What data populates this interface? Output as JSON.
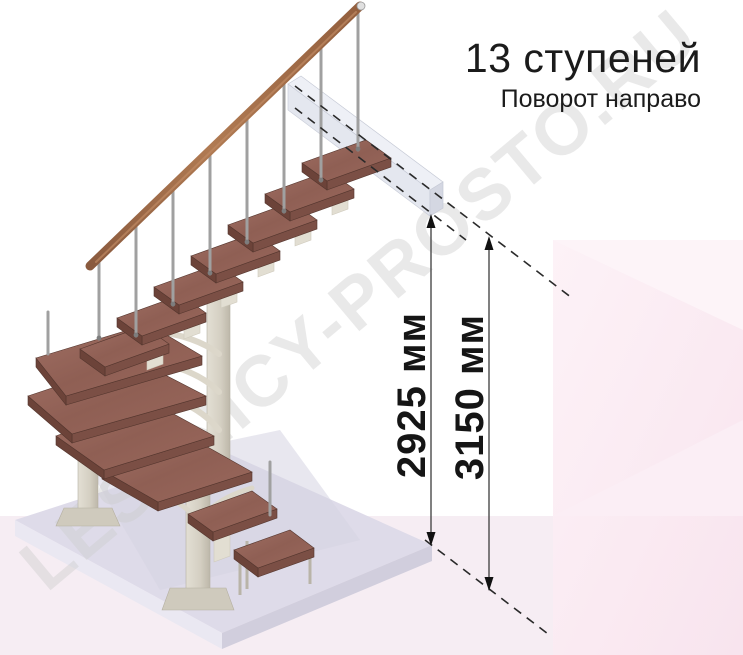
{
  "header": {
    "title": "13 ступеней",
    "subtitle": "Поворот направо"
  },
  "dimensions": {
    "lines": [
      {
        "label": "2925 мм"
      },
      {
        "label": "3150 мм"
      }
    ]
  },
  "watermark": {
    "text": "LESTNICY-PROSTO.RU"
  },
  "colors": {
    "step_wood": "#96655a",
    "step_front": "#7b4f45",
    "handrail": "#a9744f",
    "metal_baluster": "#a0a0a0",
    "support_column": "#d8d4c9",
    "floor_platform": "#dedbe9",
    "upper_floor_slab": "#e2e5ee",
    "background_pink": "#fae8f1",
    "annotation_text": "#1b1b1b"
  }
}
